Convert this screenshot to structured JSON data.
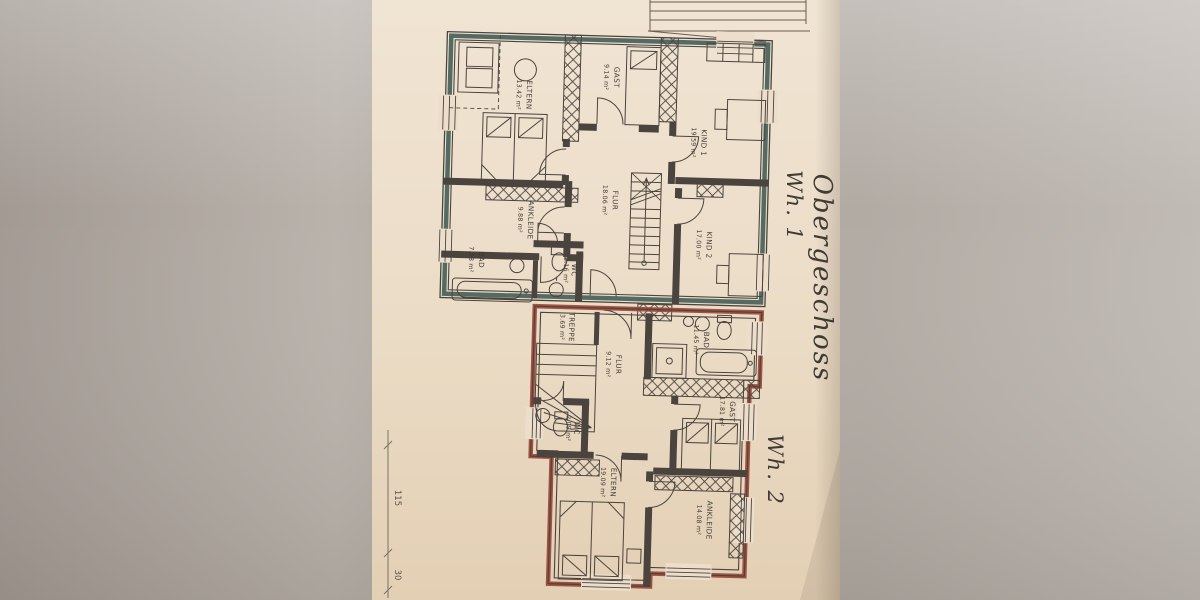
{
  "photo": {
    "description": "Photographed architectural floor plan sheet",
    "paper_color": "#ecdecb",
    "background_color": "#aaa39c",
    "plan_line_color": "#4b443e",
    "annotation_color": "#c05423"
  },
  "annotations": {
    "floor": "Obergeschoss",
    "apartment1": "Wh. 1",
    "apartment2": "Wh. 2"
  },
  "apartment1": {
    "boundary_color": "#46615a",
    "rooms": [
      {
        "name": "ELTERN",
        "area": "13.42 m²"
      },
      {
        "name": "GAST",
        "area": "9.14 m²"
      },
      {
        "name": "KIND 1",
        "area": "19.59 m²"
      },
      {
        "name": "FLUR",
        "area": "18.06 m²"
      },
      {
        "name": "KIND 2",
        "area": "17.00 m²"
      },
      {
        "name": "ANKLEIDE",
        "area": "9.88 m²"
      },
      {
        "name": "BAD",
        "area": "7.58 m²"
      },
      {
        "name": "WC",
        "area": "1.16 m²"
      }
    ]
  },
  "apartment2": {
    "boundary_color": "#9c4537",
    "rooms": [
      {
        "name": "TREPPE",
        "area": "3.69 m²"
      },
      {
        "name": "FLUR",
        "area": "9.12 m²"
      },
      {
        "name": "BAD",
        "area": "11.45 m²"
      },
      {
        "name": "GAST",
        "area": "17.81 m²"
      },
      {
        "name": "WC",
        "area": "2.09 m²"
      },
      {
        "name": "ELTERN",
        "area": "19.09 m²"
      },
      {
        "name": "ANKLEIDE",
        "area": "14.08 m²"
      }
    ]
  },
  "dimensions": {
    "left_edge": [
      "115",
      "30"
    ]
  }
}
